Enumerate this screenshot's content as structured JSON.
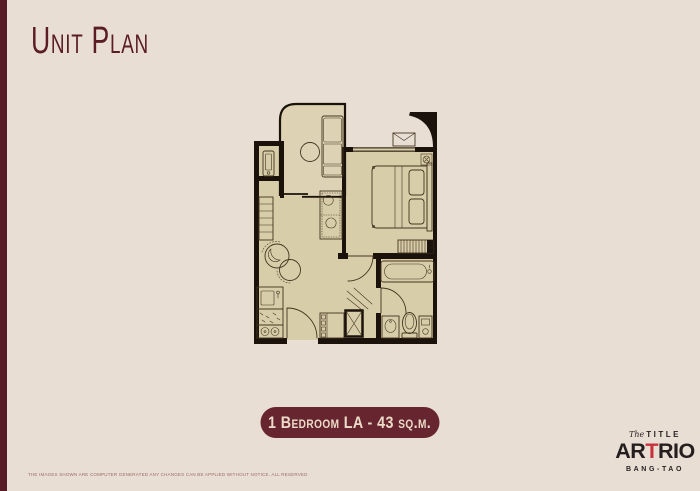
{
  "page": {
    "title": "Unit Plan",
    "background_color": "#e9ded4",
    "accent_color": "#67262f",
    "accent_dark_color": "#571c25"
  },
  "badge": {
    "label": "1 Bedroom LA - 43 sq.m.",
    "background_color": "#67262f",
    "text_color": "#ecdbc8"
  },
  "floor_plan": {
    "unit_type": "1 Bedroom LA",
    "unit_area": "43 sq.m.",
    "floor_color": "#d8cda9",
    "balcony_floor_color": "#ddd3b4",
    "wall_color": "#1b130b",
    "line_color": "#44351f",
    "rooms": [
      {
        "name": "balcony"
      },
      {
        "name": "utility-closet"
      },
      {
        "name": "living-room"
      },
      {
        "name": "kitchen"
      },
      {
        "name": "entry-hall"
      },
      {
        "name": "bedroom"
      },
      {
        "name": "bathroom"
      }
    ],
    "furniture": [
      "lounge-chair",
      "balcony-table",
      "water-heater",
      "wardrobe",
      "sofa",
      "tv-cabinet",
      "kitchen-sink",
      "kitchen-counter",
      "stove",
      "entry-door",
      "shoe-cabinet",
      "service-shaft",
      "double-bed",
      "pillows",
      "ceiling-light",
      "ac-condenser-unit",
      "built-in-closet",
      "bathtub",
      "wash-basin",
      "toilet",
      "bathroom-heater"
    ]
  },
  "logo": {
    "prefix": "The",
    "top_word": "TITLE",
    "main_pre": "AR",
    "main_accent": "T",
    "main_post": "RIO",
    "sub_word": "BANG-TAO",
    "text_color": "#241e1e",
    "accent_color": "#c8323c"
  },
  "disclaimer": "THE IMAGES SHOWN ARE COMPUTER GENERATED ANY CHANGES CAN BE APPLIED WITHOUT NOTICE. ALL RESERVED"
}
